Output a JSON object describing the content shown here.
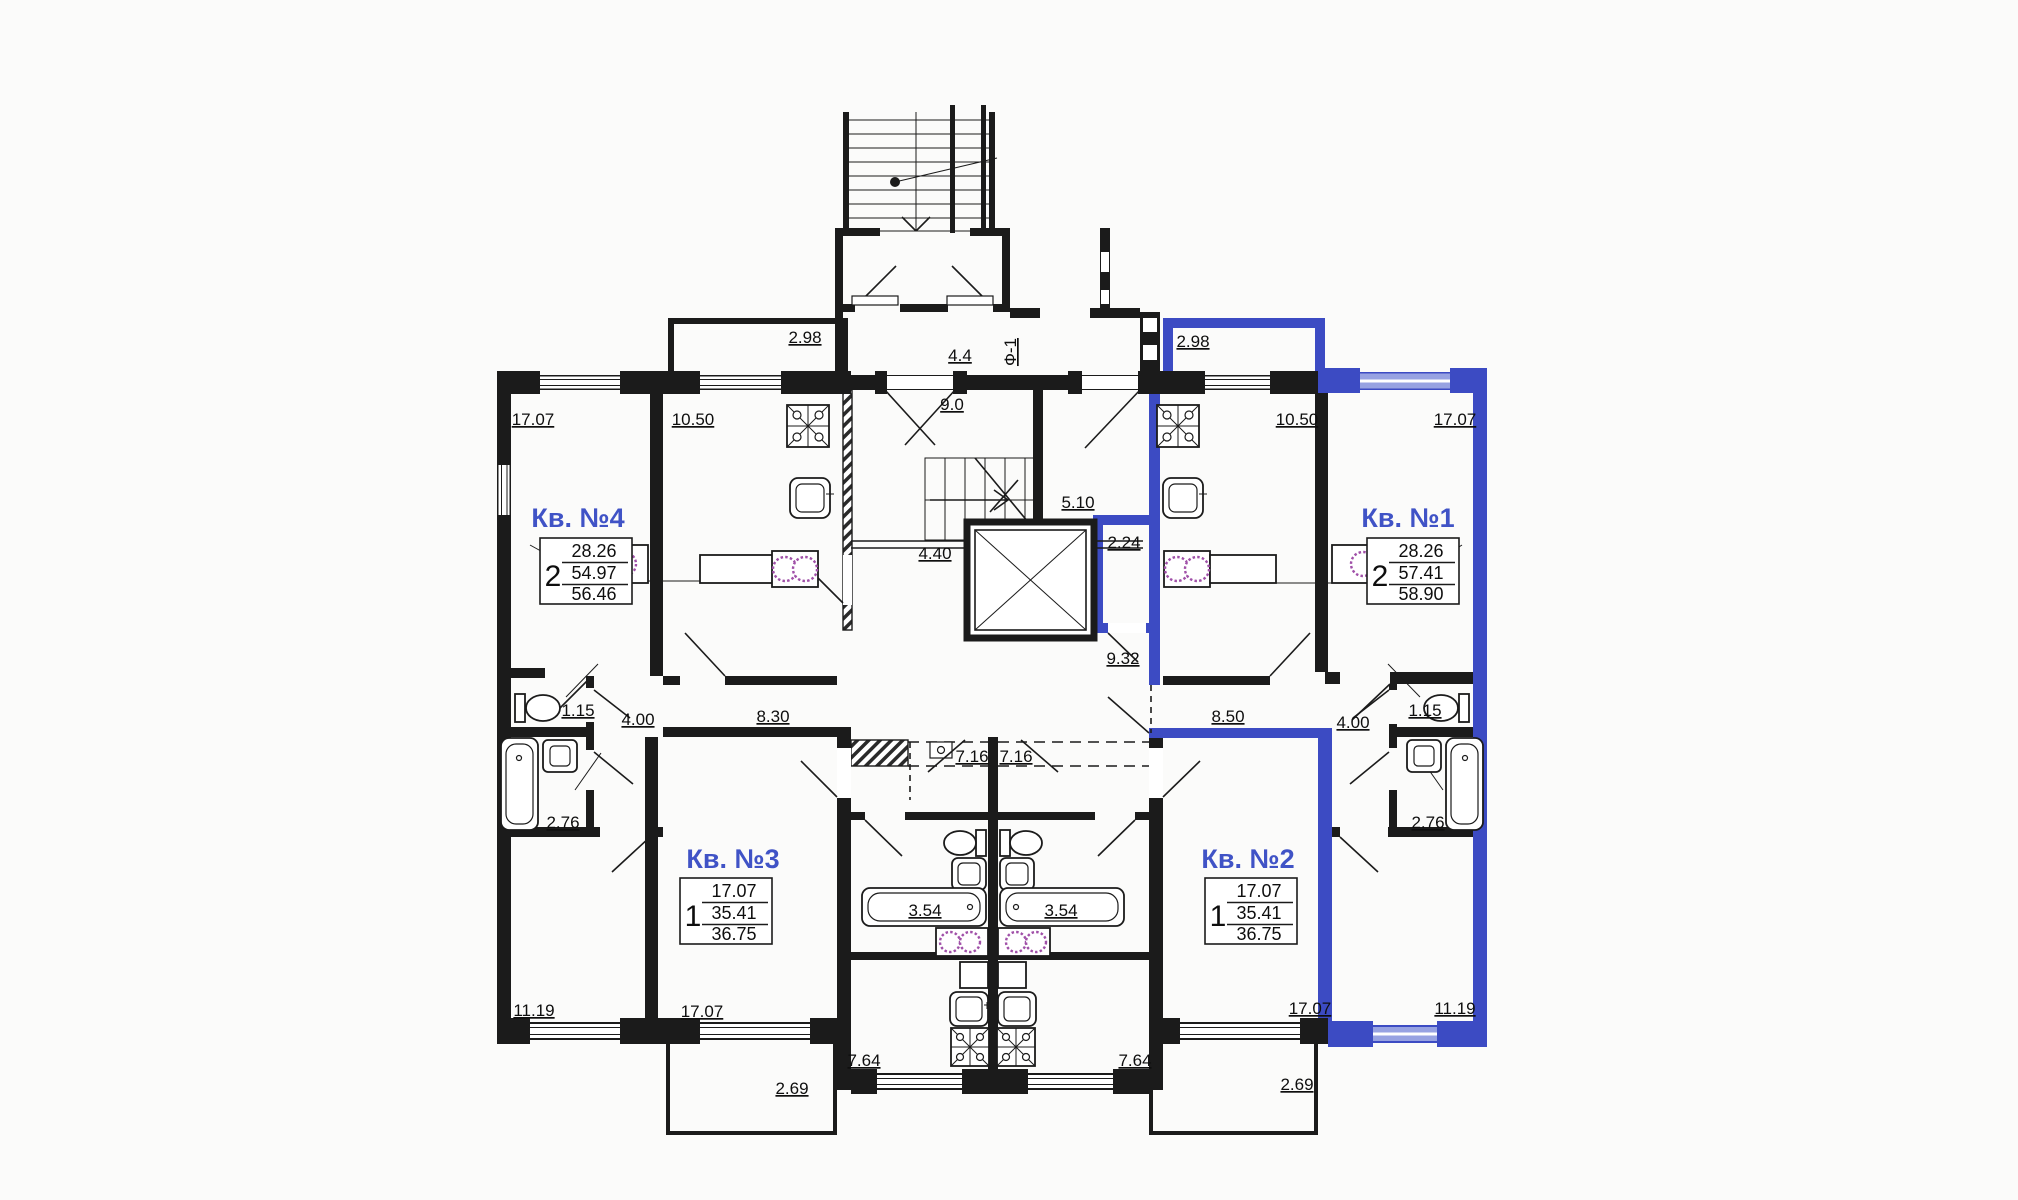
{
  "drawing_type": "floor-plan",
  "colors": {
    "wall": "#1b1b1b",
    "highlight": "#3c4bc3",
    "highlight_light": "#97a2e2",
    "apartment_label": "#4053c6",
    "washer_icon": "#a050a8",
    "background": "#fbfbfa"
  },
  "apartments": {
    "a1": {
      "name": "Кв. №1",
      "rooms": "2",
      "area_zhil": "28.26",
      "area_living": "57.41",
      "area_total": "58.90"
    },
    "a2": {
      "name": "Кв. №2",
      "rooms": "1",
      "area_zhil": "17.07",
      "area_living": "35.41",
      "area_total": "36.75"
    },
    "a3": {
      "name": "Кв. №3",
      "rooms": "1",
      "area_zhil": "17.07",
      "area_living": "35.41",
      "area_total": "36.75"
    },
    "a4": {
      "name": "Кв. №4",
      "rooms": "2",
      "area_zhil": "28.26",
      "area_living": "54.97",
      "area_total": "56.46"
    }
  },
  "dims": {
    "tl_living": "17.07",
    "tl_kitchen": "10.50",
    "bal_tl": "2.98",
    "vest_cor": "4.4",
    "f1": "Ф-1",
    "stair_room": "9.0",
    "bal_tr": "2.98",
    "tr_kitchen": "10.50",
    "tr_living": "17.07",
    "cor_510": "5.10",
    "cor_440": "4.40",
    "closet_224": "2.24",
    "lobby_932": "9.32",
    "cor_830": "8.30",
    "hall_4l": "4.00",
    "wc_l": "1.15",
    "bath_l": "2.76",
    "cor_850": "8.50",
    "hall_4r": "4.00",
    "wc_r": "1.15",
    "bath_r": "2.76",
    "cor_716l": "7.16",
    "cor_716r": "7.16",
    "bed_l": "11.19",
    "liv_3": "17.07",
    "bath_354l": "3.54",
    "bath_354r": "3.54",
    "liv_2": "17.07",
    "bed_r": "11.19",
    "kit_764l": "7.64",
    "kit_764r": "7.64",
    "bal_269l": "2.69",
    "bal_269r": "2.69"
  }
}
